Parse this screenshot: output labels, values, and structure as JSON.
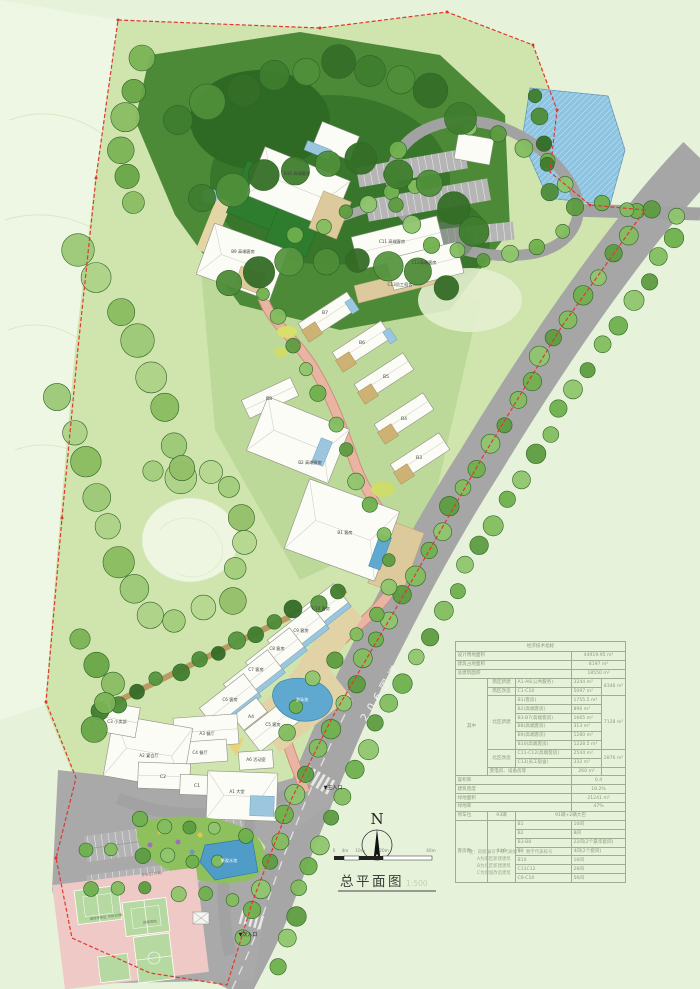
{
  "meta": {
    "title_cn": "总平面图",
    "scale": "1:500",
    "north": "N",
    "road": "206国道"
  },
  "scale_bar": {
    "ticks": [
      "0",
      "4m",
      "10m",
      "20m",
      "40m"
    ]
  },
  "site": {
    "labels": {
      "B10": "B10 高端客房",
      "B9": "B9 高端客房",
      "C11": "C11 高端客房",
      "C12": "C12高端客房",
      "C13": "C13员工宿舍",
      "B8": "B8",
      "B7": "B7",
      "B6": "B6",
      "B5": "B5",
      "B4": "B4",
      "B3": "B3",
      "B2": "B2 高端客房",
      "B1": "B1 客房",
      "C10": "C10 客房",
      "C9": "C9 客房",
      "C8": "C8 客房",
      "C7": "C7 客房",
      "C6": "C6 客房",
      "C5": "C5 客房",
      "A4": "A4",
      "A3": "A3 餐厅",
      "C4": "C4 餐厅",
      "A2": "A2 宴会厅",
      "C3": "C3 小卖部",
      "A6": "A6 活动室",
      "C2": "C2",
      "C1": "C1",
      "A1": "A1 大堂"
    },
    "annotations": {
      "pool": "游泳池",
      "water_feature": "景观水池",
      "parking_70": "停车位(70辆)",
      "temp_parking": "临时停车区 可停30辆",
      "tennis": "网球场地",
      "main_entrance": "▼主入口",
      "secondary_entrance": "▼次入口"
    }
  },
  "table": {
    "rows": [
      [
        {
          "t": "经济技术指标",
          "cs": 5,
          "al": "c",
          "hd": true
        }
      ],
      [
        {
          "t": "设计用地面积",
          "cs": 3
        },
        {
          "t": "44919.95 m²",
          "cs": 2,
          "al": "c"
        }
      ],
      [
        {
          "t": "建筑占地面积",
          "cs": 3
        },
        {
          "t": "8197 m²",
          "cs": 2,
          "al": "c"
        }
      ],
      [
        {
          "t": "总建筑面积",
          "cs": 3
        },
        {
          "t": "18550 m²",
          "cs": 2,
          "al": "c"
        }
      ],
      [
        {
          "t": "其中",
          "rs": 11,
          "al": "c"
        },
        {
          "t": "南区新建",
          "al": "c"
        },
        {
          "t": "A1-A6(公共服务)"
        },
        {
          "t": "3244 m²"
        },
        {
          "t": "8346 m²",
          "rs": 2,
          "al": "c"
        }
      ],
      [
        {
          "t": "南区改造",
          "al": "c"
        },
        {
          "t": "C1-C10"
        },
        {
          "t": "5097 m²"
        }
      ],
      [
        {
          "t": "北区新建",
          "rs": 6,
          "al": "c"
        },
        {
          "t": "B1(客房)"
        },
        {
          "t": "1755.5 m²"
        },
        {
          "t": "7128 m²",
          "rs": 6,
          "al": "c"
        }
      ],
      [
        {
          "t": "B2(高端客房)"
        },
        {
          "t": "896 m²"
        }
      ],
      [
        {
          "t": "B3-B7(高端客房)"
        },
        {
          "t": "1665 m²"
        }
      ],
      [
        {
          "t": "B8(高端客房)"
        },
        {
          "t": "313 m²"
        }
      ],
      [
        {
          "t": "B9(高端客房)"
        },
        {
          "t": "1280 m²"
        }
      ],
      [
        {
          "t": "B10(高端客房)"
        },
        {
          "t": "1228.5 m²"
        }
      ],
      [
        {
          "t": "北区改造",
          "rs": 2,
          "al": "c"
        },
        {
          "t": "C11-C12(高端客房)"
        },
        {
          "t": "2544 m²"
        },
        {
          "t": "2876 m²",
          "rs": 2,
          "al": "c"
        }
      ],
      [
        {
          "t": "C13(员工宿舍)"
        },
        {
          "t": "332 m²"
        }
      ],
      [
        {
          "t": "变电房、设备房等",
          "cs": 2
        },
        {
          "t": "260 m²",
          "al": "c"
        },
        {
          "t": ""
        }
      ],
      [
        {
          "t": "容积率",
          "cs": 3
        },
        {
          "t": "0.4",
          "cs": 2,
          "al": "c"
        }
      ],
      [
        {
          "t": "建筑密度",
          "cs": 3
        },
        {
          "t": "18.2%",
          "cs": 2,
          "al": "c"
        }
      ],
      [
        {
          "t": "绿地面积",
          "cs": 3
        },
        {
          "t": "21241 m²",
          "cs": 2,
          "al": "c"
        }
      ],
      [
        {
          "t": "绿地率",
          "cs": 3
        },
        {
          "t": "47%",
          "cs": 2,
          "al": "c"
        }
      ],
      [
        {
          "t": "停车位"
        },
        {
          "t": "93辆",
          "al": "c"
        },
        {
          "t": "91辆+2辆大巴",
          "cs": 3,
          "al": "c"
        }
      ],
      [
        {
          "t": "客房数",
          "rs": 7
        },
        {
          "t": "146",
          "rs": 7,
          "al": "c"
        },
        {
          "t": "B1"
        },
        {
          "t": "10间",
          "cs": 2
        }
      ],
      [
        {
          "t": "B2"
        },
        {
          "t": "8间",
          "cs": 2
        }
      ],
      [
        {
          "t": "B3-B8"
        },
        {
          "t": "22间(2个豪华套间)",
          "cs": 2
        }
      ],
      [
        {
          "t": "B9"
        },
        {
          "t": "4间(2个套间)",
          "cs": 2
        }
      ],
      [
        {
          "t": "B10"
        },
        {
          "t": "16间",
          "cs": 2
        }
      ],
      [
        {
          "t": "C11C12"
        },
        {
          "t": "28间",
          "cs": 2
        }
      ],
      [
        {
          "t": "C6-C10"
        },
        {
          "t": "56间",
          "cs": 2
        }
      ]
    ]
  },
  "notes": [
    "注：房屋编号字母代表如下，数字代表栋号",
    "A为南区新建建筑",
    "B为北区新建建筑",
    "C为保留改造建筑"
  ],
  "colors": {
    "boundary": "#e03830",
    "road": "#a6a6a6",
    "water": "#8ec4e0",
    "forest": "#4c8a38",
    "path_pink": "#eab4a2"
  }
}
